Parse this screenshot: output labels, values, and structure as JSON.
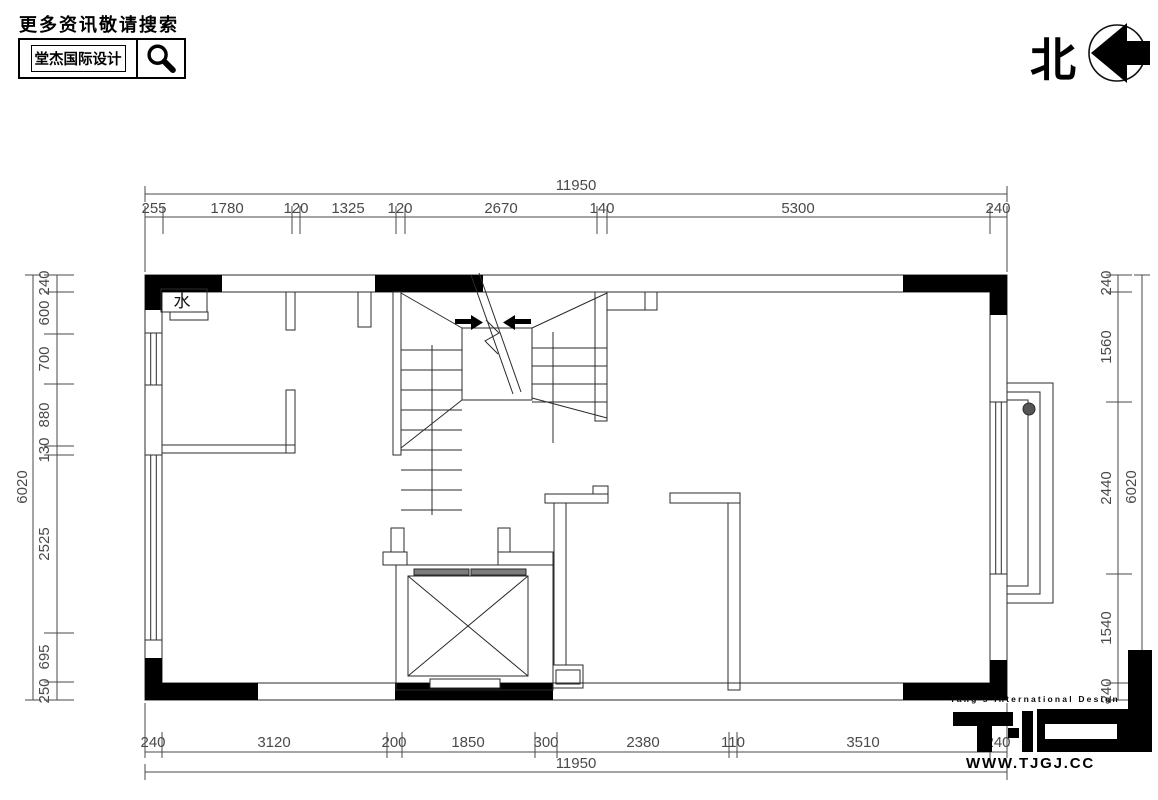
{
  "header": {
    "promo_text": "更多资讯敬请搜索",
    "brand_name": "堂杰国际设计",
    "north_label": "北"
  },
  "plan": {
    "water_label": "水"
  },
  "dimensions": {
    "top": {
      "overall": "11950",
      "segments": [
        "255",
        "1780",
        "120",
        "1325",
        "120",
        "2670",
        "140",
        "5300",
        "240"
      ]
    },
    "bottom": {
      "overall": "11950",
      "segments": [
        "240",
        "3120",
        "200",
        "1850",
        "300",
        "2380",
        "110",
        "3510",
        "240"
      ]
    },
    "left": {
      "overall": "6020",
      "segments": [
        "240",
        "600",
        "700",
        "880",
        "130",
        "2525",
        "695",
        "250"
      ]
    },
    "right": {
      "overall": "6020",
      "segments": [
        "240",
        "1560",
        "2440",
        "1540",
        "240"
      ]
    }
  },
  "footer": {
    "tagline": "Tang's International Design",
    "website": "WWW.TJGJ.CC"
  },
  "colors": {
    "line": "#2b2b2b",
    "dim_text": "#4a4a4a",
    "wall_fill": "#000000",
    "sill_gray": "#7d7d7d"
  }
}
